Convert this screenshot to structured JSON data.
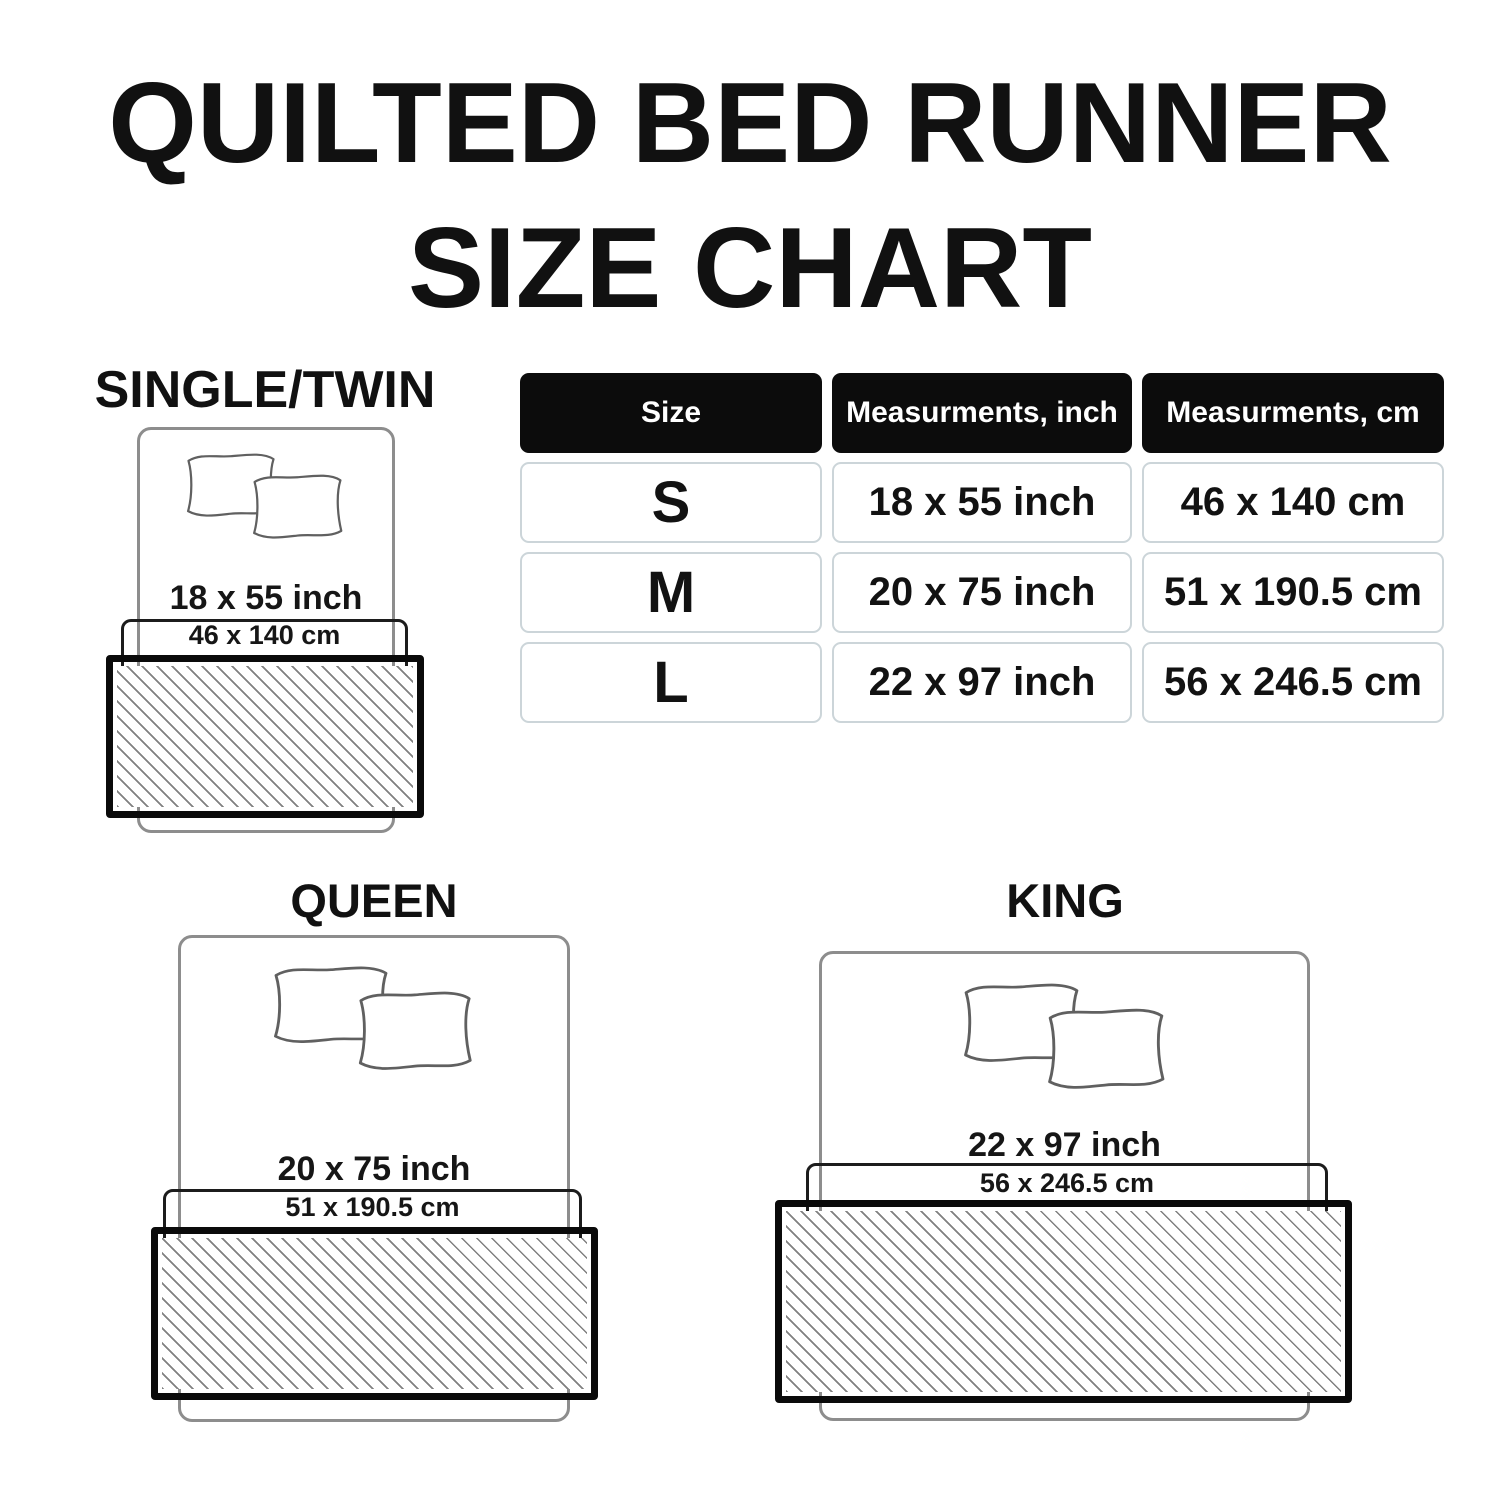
{
  "title": {
    "line1": "QUILTED BED RUNNER",
    "line2": "SIZE CHART"
  },
  "size_table": {
    "headers": [
      "Size",
      "Measurments, inch",
      "Measurments, cm"
    ],
    "rows": [
      {
        "size": "S",
        "inch": "18 x 55 inch",
        "cm": "46 x 140 cm"
      },
      {
        "size": "M",
        "inch": "20 x 75 inch",
        "cm": "51 x 190.5 cm"
      },
      {
        "size": "L",
        "inch": "22 x 97 inch",
        "cm": "56 x 246.5 cm"
      }
    ]
  },
  "diagrams": {
    "single_twin": {
      "label": "SINGLE/TWIN",
      "inch": "18 x 55 inch",
      "cm": "46 x 140 cm"
    },
    "queen": {
      "label": "QUEEN",
      "inch": "20 x 75 inch",
      "cm": "51 x 190.5 cm"
    },
    "king": {
      "label": "KING",
      "inch": "22 x 97 inch",
      "cm": "56 x 246.5 cm"
    }
  },
  "icons": {
    "pillow": "pillow-icon",
    "bed": "bed-outline",
    "runner": "hatched-runner-swatch"
  },
  "colors": {
    "background": "#ffffff",
    "text": "#111111",
    "table_header_bg": "#0c0c0c",
    "table_header_text": "#ffffff",
    "table_cell_border": "#ccd5d9",
    "bed_outline": "#8d8d8d",
    "pillow_outline": "#606060",
    "cm_box_outline": "#1c1c1c",
    "runner_border": "#0a0a0a",
    "hatch_line": "#808080"
  }
}
